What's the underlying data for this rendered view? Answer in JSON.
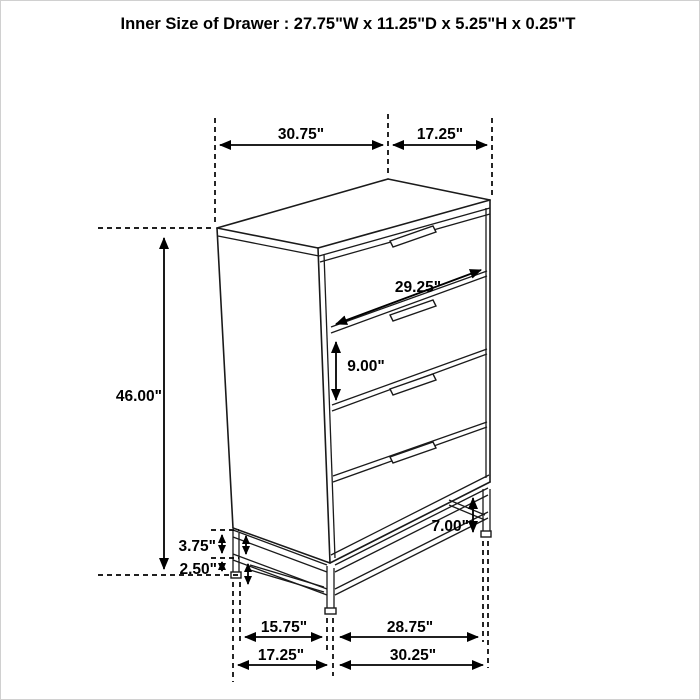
{
  "title": "Inner Size of Drawer : 27.75\"W x 11.25\"D x 5.25\"H x 0.25\"T",
  "diagram": {
    "item": "4-drawer chest dimension line drawing",
    "colors": {
      "line": "#1a1a1a",
      "background": "#ffffff",
      "border": "#d0d0d0"
    },
    "dims": {
      "top_width": "30.75\"",
      "top_depth": "17.25\"",
      "overall_height": "46.00\"",
      "drawer_width": "29.25\"",
      "drawer_height": "9.00\"",
      "base_upper_gap": "3.75\"",
      "base_lower_gap": "2.50\"",
      "leg_height": "7.00\"",
      "base_inner_depth": "15.75\"",
      "base_inner_width": "28.75\"",
      "floor_depth": "17.25\"",
      "floor_width": "30.25\""
    }
  }
}
